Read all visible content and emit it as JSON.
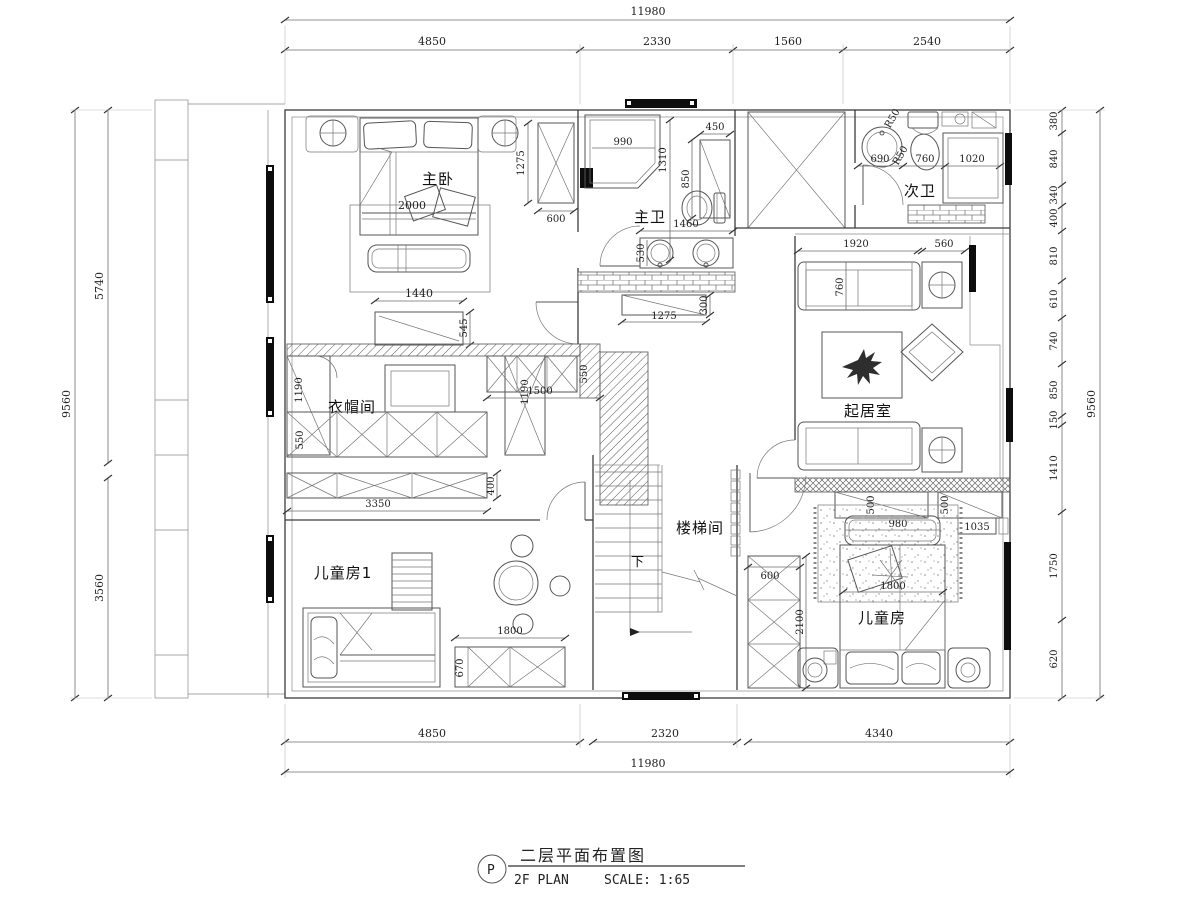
{
  "title_block": {
    "mark": "P",
    "title_cn": "二层平面布置图",
    "title_en": "2F PLAN",
    "scale": "SCALE: 1:65"
  },
  "rooms": {
    "master_bedroom": "主卧",
    "master_bath": "主卫",
    "second_bath": "次卫",
    "cloakroom": "衣帽间",
    "living_room": "起居室",
    "stairwell": "楼梯间",
    "kids_room_1": "儿童房1",
    "kids_room": "儿童房",
    "stairs_down": "下"
  },
  "dims": {
    "top": {
      "overall": "11980",
      "segs": [
        "4850",
        "2330",
        "1560",
        "2540"
      ]
    },
    "bottom": {
      "overall": "11980",
      "segs": [
        "4850",
        "2320",
        "4340"
      ]
    },
    "left": {
      "overall": "9560",
      "segs": [
        "5740",
        "3560"
      ]
    },
    "right": {
      "overall": "9560",
      "segs": [
        "380",
        "840",
        "340",
        "400",
        "810",
        "610",
        "740",
        "850",
        "150",
        "1410",
        "1750",
        "620"
      ]
    },
    "master_bedroom": {
      "bed": "2000",
      "dresser_w": "1440",
      "dresser_d": "545",
      "wardrobe_h": "1275",
      "wardrobe_w": "600"
    },
    "master_bath": {
      "shower": "990",
      "depth": "1310",
      "niche": "450",
      "cabinet": "850",
      "vanity_w": "1460",
      "vanity_d": "530",
      "lower_w": "1275",
      "lower_d": "300"
    },
    "second_bath": {
      "sink": "690",
      "toilet": "760",
      "r1": "R50",
      "r2": "R50",
      "shower": "1020"
    },
    "living": {
      "sofa_w": "1920",
      "side": "560",
      "sofa_d": "760"
    },
    "cloak": {
      "left_d": "1190",
      "right_d": "1190",
      "row_d": "550",
      "cab_d": "550",
      "corridor": "1500",
      "bottom_w": "3350",
      "bottom_d": "400"
    },
    "stair": {
      "cab_w": "600",
      "cab_h": "2100"
    },
    "kids": {
      "ward1": "500",
      "ward2": "500",
      "rug": "980",
      "tag": "1035",
      "bed": "1800"
    },
    "kids1": {
      "cab_w": "1800",
      "cab_d": "670"
    }
  }
}
